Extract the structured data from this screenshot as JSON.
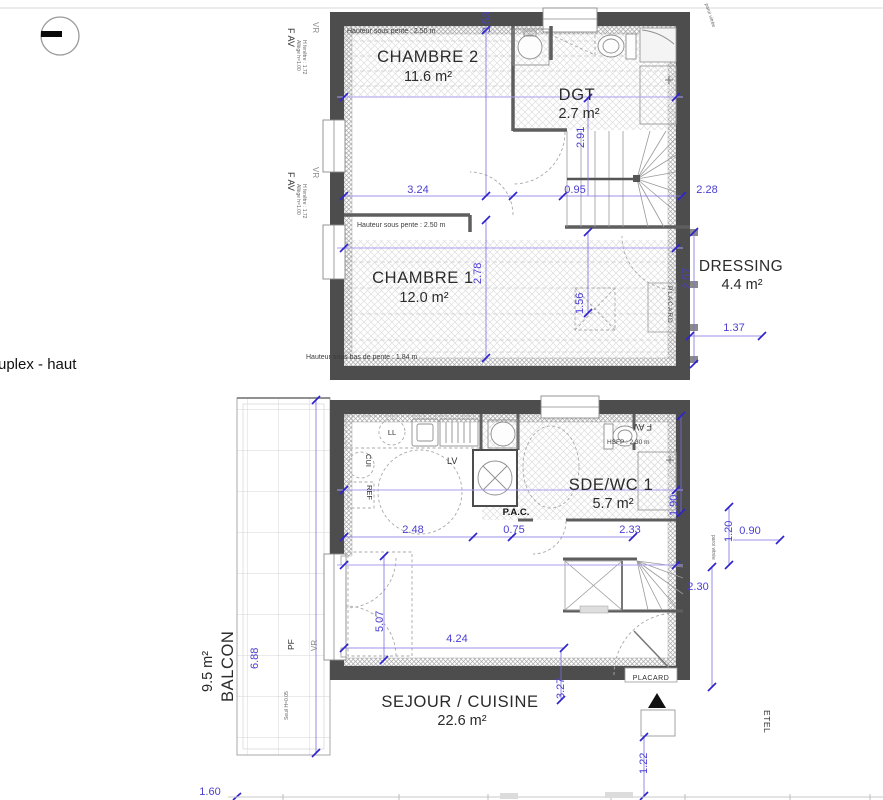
{
  "page": {
    "title": "uplex - haut"
  },
  "colors": {
    "wall": "#4d4d4d",
    "dimension": "#4a3ed2",
    "pente_line": "#ab9ff0",
    "text": "#2b2b2b"
  },
  "upper_floor": {
    "rooms": {
      "chambre2": {
        "name": "CHAMBRE 2",
        "area": "11.6 m²"
      },
      "dgt": {
        "name": "DGT",
        "area": "2.7 m²"
      },
      "chambre1": {
        "name": "CHAMBRE 1",
        "area": "12.0 m²"
      },
      "dressing": {
        "name": "DRESSING",
        "area": "4.4 m²"
      }
    },
    "notes": {
      "pente_top": "Hauteur sous pente : 2.50 m",
      "pente_mid": "Hauteur sous pente : 2.50 m",
      "pente_bottom": "Hauteur sous bas de pente : 1.84 m"
    },
    "labels": {
      "placard": "PLACARD",
      "fav": "F AV",
      "vr": "VR",
      "fav_sub1": "Allège h=1.00",
      "fav_sub2": "H fenêtre : 1.72",
      "paroi_vitree": "paroi vitrée"
    },
    "dims": {
      "w1": "3.24",
      "w2": "0.95",
      "w3": "2.28",
      "h1": "3.53",
      "h2": "2.91",
      "h3": "2.78",
      "h4": "1.56",
      "h5": "2.57",
      "d137": "1.37"
    }
  },
  "lower_floor": {
    "rooms": {
      "sejour_cuisine": {
        "name": "SEJOUR / CUISINE",
        "area": "22.6 m²"
      },
      "sde_wc": {
        "name": "SDE/WC 1",
        "area": "5.7 m²"
      },
      "balcon": {
        "name": "BALCON",
        "area": "9.5 m²"
      }
    },
    "labels": {
      "ll": "LL",
      "lv": "LV",
      "cui": "CUI",
      "ref": "REF",
      "pac": "P.A.C.",
      "placard": "PLACARD",
      "pf": "PF",
      "vr": "VR",
      "fav": "F AV",
      "hsfp": "HSFP : 2.30 m",
      "etel": "ETEL",
      "paroi_vitree": "paroi vitrée",
      "seuil": "Seuil H=0.05"
    },
    "dims": {
      "k248": "2.48",
      "k075": "0.75",
      "k233": "2.33",
      "v190": "1.90",
      "v120": "1.20",
      "h090": "0.90",
      "v230": "2.30",
      "v507": "5.07",
      "h424": "4.24",
      "v327": "3.27",
      "v688": "6.88",
      "v122": "1.22",
      "h160": "1.60"
    }
  }
}
